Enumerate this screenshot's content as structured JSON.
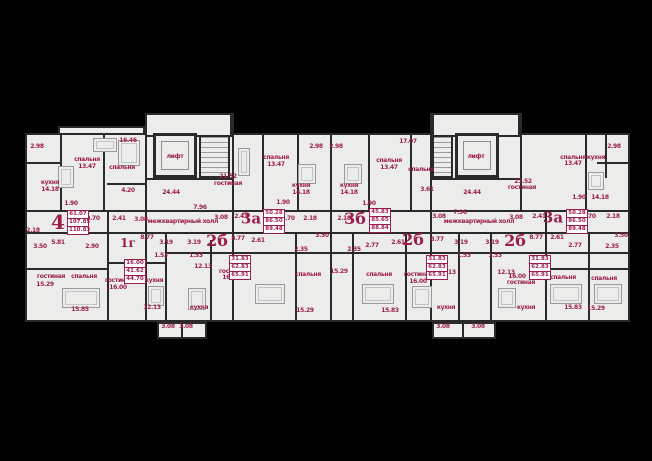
{
  "palette": {
    "background": "#000000",
    "floor_fill": "#ecedea",
    "wall_color": "#2a2a2a",
    "accent_crimson": "#9c1c4f",
    "furniture_gray": "#9a9a9a"
  },
  "plan": {
    "lift_label": "лифт",
    "hall_label": "межквартирный холл"
  },
  "apartments": [
    {
      "id": "apt-4",
      "type": "4",
      "living_area": "61.07",
      "area": "107.85",
      "total_area": "110.83",
      "label_pos": {
        "x": 58,
        "y": 222,
        "size": 20
      },
      "box_pos": {
        "x": 67,
        "y": 210
      }
    },
    {
      "id": "apt-1g",
      "type": "1г",
      "living_area": "16.00",
      "area": "41.62",
      "total_area": "44.70",
      "label_pos": {
        "x": 128,
        "y": 243,
        "size": 12
      },
      "box_pos": {
        "x": 124,
        "y": 259
      }
    },
    {
      "id": "apt-2b-left",
      "type": "2б",
      "living_area": "31.83",
      "area": "62.83",
      "total_area": "65.91",
      "label_pos": {
        "x": 217,
        "y": 241,
        "size": 16
      },
      "box_pos": {
        "x": 229,
        "y": 255
      }
    },
    {
      "id": "apt-3a-center",
      "type": "3а",
      "living_area": "50.28",
      "area": "86.50",
      "total_area": "89.48",
      "label_pos": {
        "x": 251,
        "y": 219,
        "size": 15
      },
      "box_pos": {
        "x": 263,
        "y": 209
      }
    },
    {
      "id": "apt-3b",
      "type": "3б",
      "living_area": "45.83",
      "area": "85.65",
      "total_area": "88.84",
      "label_pos": {
        "x": 355,
        "y": 219,
        "size": 16
      },
      "box_pos": {
        "x": 369,
        "y": 208
      }
    },
    {
      "id": "apt-2b-mid",
      "type": "2б",
      "living_area": "31.83",
      "area": "62.83",
      "total_area": "65.91",
      "label_pos": {
        "x": 413,
        "y": 240,
        "size": 16
      },
      "box_pos": {
        "x": 426,
        "y": 255
      }
    },
    {
      "id": "apt-2b-right",
      "type": "2б",
      "living_area": "31.83",
      "area": "62.83",
      "total_area": "65.91",
      "label_pos": {
        "x": 515,
        "y": 241,
        "size": 16
      },
      "box_pos": {
        "x": 529,
        "y": 255
      }
    },
    {
      "id": "apt-3a-right",
      "type": "3а",
      "living_area": "50.28",
      "area": "86.50",
      "total_area": "89.48",
      "label_pos": {
        "x": 553,
        "y": 218,
        "size": 15
      },
      "box_pos": {
        "x": 566,
        "y": 209
      }
    }
  ],
  "labels": [
    {
      "t": "2.98",
      "x": 37,
      "y": 147
    },
    {
      "t": "кухня",
      "x": 50,
      "y": 183
    },
    {
      "t": "14.18",
      "x": 50,
      "y": 190
    },
    {
      "t": "спальня",
      "x": 87,
      "y": 160
    },
    {
      "t": "13.47",
      "x": 87,
      "y": 167
    },
    {
      "t": "16.46",
      "x": 128,
      "y": 141
    },
    {
      "t": "спальня",
      "x": 122,
      "y": 168
    },
    {
      "t": "4.20",
      "x": 128,
      "y": 191
    },
    {
      "t": "1.90",
      "x": 71,
      "y": 204
    },
    {
      "t": "9.70",
      "x": 93,
      "y": 219
    },
    {
      "t": "2.41",
      "x": 119,
      "y": 219
    },
    {
      "t": "3.08",
      "x": 141,
      "y": 220
    },
    {
      "t": "2.18",
      "x": 33,
      "y": 231
    },
    {
      "t": "3.50",
      "x": 40,
      "y": 247
    },
    {
      "t": "5.81",
      "x": 58,
      "y": 243
    },
    {
      "t": "2.90",
      "x": 92,
      "y": 247
    },
    {
      "t": "гостиная",
      "x": 51,
      "y": 277
    },
    {
      "t": "15.29",
      "x": 45,
      "y": 285
    },
    {
      "t": "спальня",
      "x": 84,
      "y": 277
    },
    {
      "t": "15.85",
      "x": 80,
      "y": 310
    },
    {
      "t": "8.77",
      "x": 147,
      "y": 238
    },
    {
      "t": "3.19",
      "x": 166,
      "y": 243
    },
    {
      "t": "1.53",
      "x": 161,
      "y": 256
    },
    {
      "t": "гостиная",
      "x": 119,
      "y": 281
    },
    {
      "t": "16.00",
      "x": 118,
      "y": 288
    },
    {
      "t": "кухня",
      "x": 154,
      "y": 281
    },
    {
      "t": "12.13",
      "x": 152,
      "y": 308
    },
    {
      "t": "3.19",
      "x": 194,
      "y": 243
    },
    {
      "t": "1.53",
      "x": 196,
      "y": 256
    },
    {
      "t": "12.13",
      "x": 203,
      "y": 267
    },
    {
      "t": "кухня",
      "x": 199,
      "y": 308
    },
    {
      "t": "3.08",
      "x": 168,
      "y": 327
    },
    {
      "t": "3.08",
      "x": 186,
      "y": 327
    },
    {
      "t": "лифт",
      "x": 175,
      "y": 157,
      "n": "lift-label"
    },
    {
      "t": "24.44",
      "x": 171,
      "y": 193
    },
    {
      "t": "7.96",
      "x": 200,
      "y": 208
    },
    {
      "t": "межквартирный холл",
      "x": 183,
      "y": 222,
      "n": "hall-label"
    },
    {
      "t": "3.08",
      "x": 221,
      "y": 218
    },
    {
      "t": "8.77",
      "x": 238,
      "y": 239
    },
    {
      "t": "2.61",
      "x": 258,
      "y": 241
    },
    {
      "t": "гостиная",
      "x": 233,
      "y": 272
    },
    {
      "t": "16.00",
      "x": 231,
      "y": 278
    },
    {
      "t": "2.41",
      "x": 241,
      "y": 217
    },
    {
      "t": "21.52",
      "x": 228,
      "y": 177
    },
    {
      "t": "гостиная",
      "x": 228,
      "y": 184
    },
    {
      "t": "спальня",
      "x": 276,
      "y": 158
    },
    {
      "t": "13.47",
      "x": 276,
      "y": 165
    },
    {
      "t": "2.98",
      "x": 316,
      "y": 147
    },
    {
      "t": "кухня",
      "x": 301,
      "y": 186
    },
    {
      "t": "14.18",
      "x": 301,
      "y": 193
    },
    {
      "t": "1.90",
      "x": 283,
      "y": 203
    },
    {
      "t": "9.70",
      "x": 288,
      "y": 219
    },
    {
      "t": "2.18",
      "x": 310,
      "y": 219
    },
    {
      "t": "3.50",
      "x": 322,
      "y": 236
    },
    {
      "t": "2.35",
      "x": 301,
      "y": 250
    },
    {
      "t": "спальня",
      "x": 308,
      "y": 275
    },
    {
      "t": "15.29",
      "x": 305,
      "y": 311
    },
    {
      "t": "2.98",
      "x": 336,
      "y": 147
    },
    {
      "t": "кухня",
      "x": 349,
      "y": 186
    },
    {
      "t": "14.18",
      "x": 349,
      "y": 193
    },
    {
      "t": "спальня",
      "x": 389,
      "y": 161
    },
    {
      "t": "13.47",
      "x": 389,
      "y": 168
    },
    {
      "t": "17.07",
      "x": 408,
      "y": 142
    },
    {
      "t": "спальня",
      "x": 421,
      "y": 170
    },
    {
      "t": "3.61",
      "x": 427,
      "y": 190
    },
    {
      "t": "1.90",
      "x": 369,
      "y": 204
    },
    {
      "t": "2.18",
      "x": 344,
      "y": 219
    },
    {
      "t": "9.70",
      "x": 377,
      "y": 218
    },
    {
      "t": "2.35",
      "x": 354,
      "y": 250
    },
    {
      "t": "2.77",
      "x": 372,
      "y": 246
    },
    {
      "t": "2.61",
      "x": 398,
      "y": 243
    },
    {
      "t": "15.29",
      "x": 339,
      "y": 272
    },
    {
      "t": "спальня",
      "x": 379,
      "y": 275
    },
    {
      "t": "15.83",
      "x": 390,
      "y": 311
    },
    {
      "t": "8.77",
      "x": 437,
      "y": 240
    },
    {
      "t": "гостиная",
      "x": 418,
      "y": 275
    },
    {
      "t": "16.00",
      "x": 418,
      "y": 282
    },
    {
      "t": "12.13",
      "x": 447,
      "y": 273
    },
    {
      "t": "кухня",
      "x": 446,
      "y": 308
    },
    {
      "t": "3.08",
      "x": 443,
      "y": 327
    },
    {
      "t": "3.08",
      "x": 478,
      "y": 327
    },
    {
      "t": "3.19",
      "x": 461,
      "y": 243
    },
    {
      "t": "1.53",
      "x": 464,
      "y": 256
    },
    {
      "t": "лифт",
      "x": 476,
      "y": 157,
      "n": "lift-label"
    },
    {
      "t": "24.44",
      "x": 472,
      "y": 193
    },
    {
      "t": "7.96",
      "x": 460,
      "y": 213
    },
    {
      "t": "межквартирный холл",
      "x": 479,
      "y": 222,
      "n": "hall-label"
    },
    {
      "t": "3.08",
      "x": 439,
      "y": 217
    },
    {
      "t": "3.08",
      "x": 516,
      "y": 218
    },
    {
      "t": "3.19",
      "x": 492,
      "y": 243
    },
    {
      "t": "1.53",
      "x": 495,
      "y": 256
    },
    {
      "t": "12.13",
      "x": 506,
      "y": 273
    },
    {
      "t": "кухня",
      "x": 526,
      "y": 308
    },
    {
      "t": "16.00",
      "x": 517,
      "y": 277
    },
    {
      "t": "гостиная",
      "x": 521,
      "y": 283
    },
    {
      "t": "8.77",
      "x": 536,
      "y": 238
    },
    {
      "t": "2.61",
      "x": 557,
      "y": 238
    },
    {
      "t": "2.77",
      "x": 575,
      "y": 246
    },
    {
      "t": "2.35",
      "x": 612,
      "y": 247
    },
    {
      "t": "спальня",
      "x": 563,
      "y": 278
    },
    {
      "t": "15.83",
      "x": 573,
      "y": 308
    },
    {
      "t": "2.41",
      "x": 539,
      "y": 217
    },
    {
      "t": "21.52",
      "x": 523,
      "y": 182
    },
    {
      "t": "гостиная",
      "x": 522,
      "y": 188
    },
    {
      "t": "спальня",
      "x": 573,
      "y": 158
    },
    {
      "t": "13.47",
      "x": 573,
      "y": 164
    },
    {
      "t": "кухня",
      "x": 596,
      "y": 158
    },
    {
      "t": "2.98",
      "x": 614,
      "y": 147
    },
    {
      "t": "1.90",
      "x": 579,
      "y": 198
    },
    {
      "t": "14.18",
      "x": 600,
      "y": 198
    },
    {
      "t": "9.70",
      "x": 589,
      "y": 217
    },
    {
      "t": "2.18",
      "x": 613,
      "y": 217
    },
    {
      "t": "3.50",
      "x": 621,
      "y": 236
    },
    {
      "t": "спальня",
      "x": 604,
      "y": 279
    },
    {
      "t": "15.29",
      "x": 596,
      "y": 309
    }
  ]
}
